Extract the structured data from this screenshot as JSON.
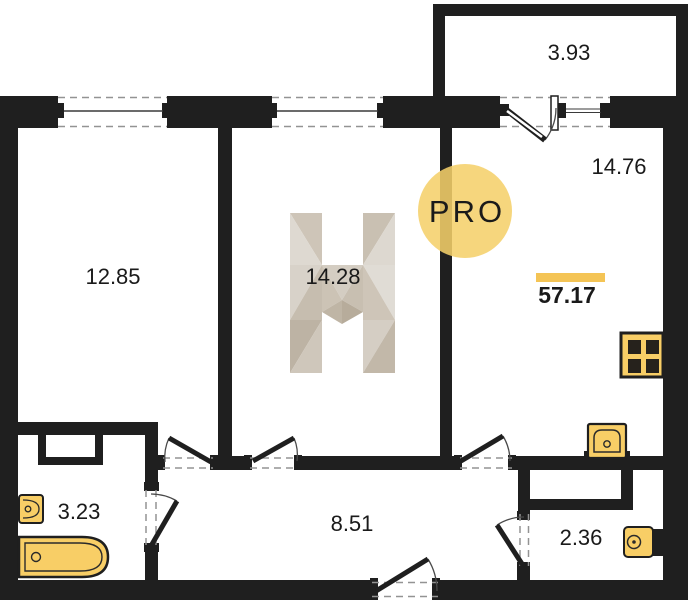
{
  "colors": {
    "wall": "#1f1f1f",
    "fixture_fill": "#f8ce66",
    "accent_bar": "#f4c455",
    "logo_circle": "#f5d06a",
    "logo_text": "#8b8b83",
    "dash": "#939393",
    "watermark_light": "#ded9d1",
    "watermark_mid": "#cec5b8",
    "watermark_dark": "#b7ac9b"
  },
  "labels": {
    "balcony_area": "3.93",
    "kitchen_living_area": "14.76",
    "room_left_area": "12.85",
    "room_middle_area": "14.28",
    "bathroom_area": "3.23",
    "hallway_area": "8.51",
    "wc_area": "2.36",
    "total_area": "57.17"
  },
  "logo": {
    "text": "PRO"
  }
}
